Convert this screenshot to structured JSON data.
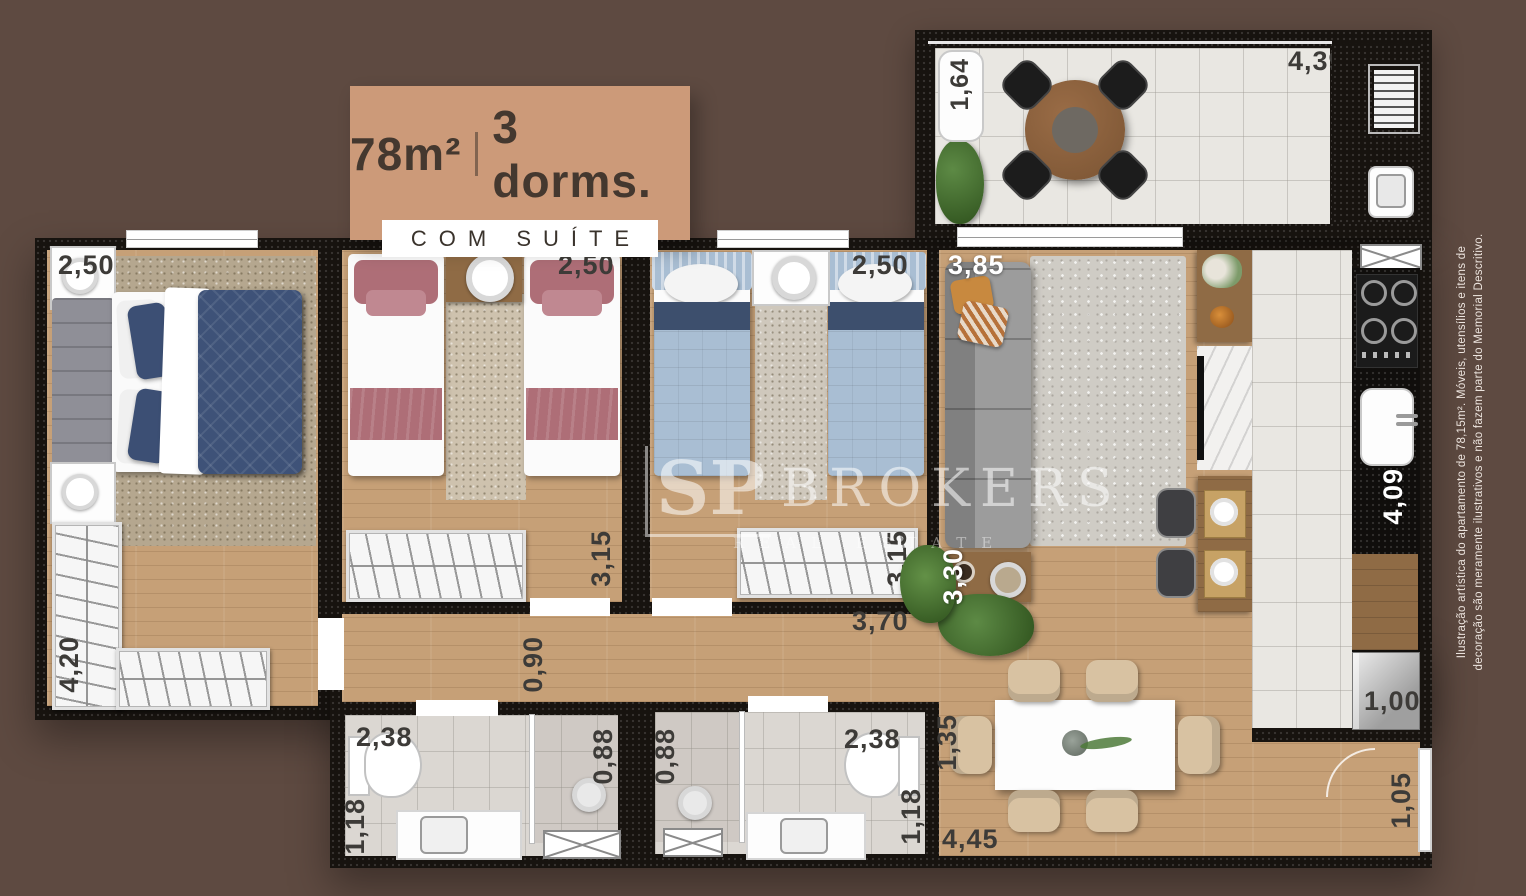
{
  "badge": {
    "area": "78m²",
    "dorms": "3 dorms.",
    "subtitle": "COM SUÍTE"
  },
  "watermark": {
    "brand_prefix": "SP",
    "brand": "BROKERS",
    "tagline": "REAL ESTATE"
  },
  "disclaimer": {
    "line1": "Ilustração artística do apartamento de 78,15m². Móveis, utensílios e itens de",
    "line2": "decoração são meramente ilustrativos e não fazem parte do Memorial Descritivo."
  },
  "dimensions": {
    "balcony_depth": "1,64",
    "balcony_width": "4,39",
    "suite_width": "2,50",
    "suite_wardrobe": "4,20",
    "bedroom2_width": "2,50",
    "bedroom2_depth": "3,15",
    "bedroom3_width": "2,50",
    "bedroom3_depth": "3,15",
    "living_width": "3,85",
    "living_depth": "3,30",
    "kitchen_length": "4,09",
    "kitchen_fridge": "1,00",
    "hall_width": "0,90",
    "hall_length": "3,70",
    "bath1_width": "2,38",
    "bath1_shower": "0,88",
    "bath1_depth": "1,18",
    "bath2_shower": "0,88",
    "bath2_width": "2,38",
    "bath2_depth": "1,18",
    "dining_depth": "1,35",
    "dining_width": "4,45",
    "entry_width": "1,05"
  },
  "colors": {
    "bg": "#5E4A41",
    "badge": "#CC9A79",
    "badgetext": "#44382F",
    "wall": "#17130F",
    "wood": "#C6A077",
    "tile": "#E9E7E2",
    "bathtile": "#DBD7D2",
    "rugbeige": "#B5A78F",
    "ruggray": "#CFCCC5",
    "navy": "#3E5278",
    "rose": "#AE6E77",
    "lightblue": "#A9BED3",
    "sofagray": "#9C9C9C",
    "chairbeige": "#D8C2A2",
    "counterwood": "#8F6B45",
    "labeldark": "#3D3B38",
    "greenery": "#4E7A3A"
  }
}
